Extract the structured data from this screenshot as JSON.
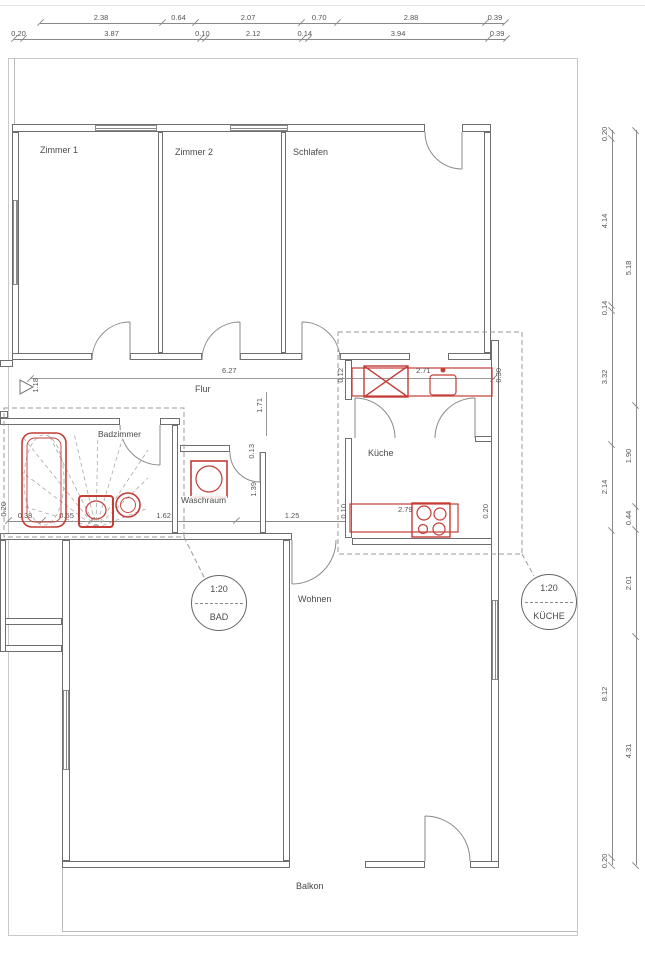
{
  "rooms": {
    "zimmer1": "Zimmer 1",
    "zimmer2": "Zimmer 2",
    "schlafen": "Schlafen",
    "flur": "Flur",
    "badzimmer": "Badzimmer",
    "waschraum": "Waschraum",
    "kueche": "Küche",
    "wohnen": "Wohnen",
    "balkon": "Balkon"
  },
  "detail_circles": [
    {
      "scale": "1:20",
      "label": "BAD"
    },
    {
      "scale": "1:20",
      "label": "KÜCHE"
    }
  ],
  "dims": {
    "top_chain_1": [
      "2.38",
      "0.64",
      "2.07",
      "0.70",
      "2.88",
      "0.39"
    ],
    "top_chain_2": [
      "0.20",
      "3.87",
      "0.10",
      "2.12",
      "0.14",
      "3.94",
      "0.39"
    ],
    "right_chain_inner": [
      "0.20",
      "4.14",
      "0.14",
      "3.32",
      "2.14",
      "8.12",
      "0.20"
    ],
    "right_chain_outer": [
      "5.18",
      "1.90",
      "0.44",
      "2.01",
      "4.31"
    ],
    "bath_chain": [
      "0.38",
      "0.55",
      "1.62",
      "1.25"
    ],
    "flur_length": "6.27",
    "entry_width": "1.18",
    "hall_door": "1.71",
    "wasch_door": "0.13",
    "wasch_depth": "1.39",
    "bath_wall": "0.20",
    "kitchen_counter_top": "2.71",
    "kitchen_top_left": "0.12",
    "kitchen_top_right": "0.30",
    "kitchen_counter_bottom": "2.79",
    "kitchen_bottom_left": "0.10",
    "kitchen_bottom_right": "0.20"
  },
  "colors": {
    "fixture_red": "#c43c35",
    "wall_line": "#6e6e6e",
    "thin_line": "#9a9a9a",
    "dim_text": "#555555"
  }
}
